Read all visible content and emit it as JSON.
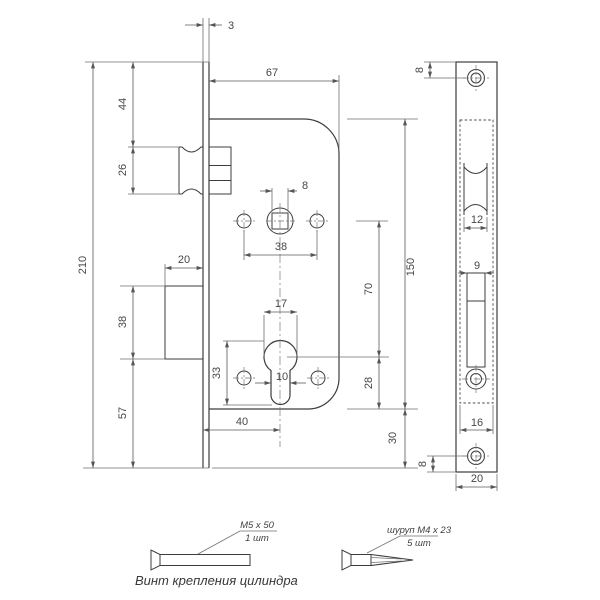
{
  "left_view": {
    "dims": {
      "faceplate_thickness": "3",
      "body_width": "67",
      "top_to_latch": "44",
      "latch_height": "26",
      "total_height": "210",
      "deadbolt_depth": "20",
      "deadbolt_height": "38",
      "bottom_margin": "57",
      "spindle_square": "8",
      "handle_screw_spacing": "38",
      "body_height": "150",
      "spindle_to_cylinder": "70",
      "cylinder_to_bottom": "28",
      "body_to_plate_bottom": "30",
      "cylinder_width": "17",
      "cylinder_height": "33",
      "cylinder_slot_width": "10",
      "backset": "40"
    }
  },
  "right_view": {
    "dims": {
      "top_screw_offset": "8",
      "latch_width": "12",
      "deadbolt_slot_width": "9",
      "body_width": "16",
      "bottom_screw_offset": "8",
      "plate_width": "20"
    }
  },
  "hardware": {
    "cylinder_screw": {
      "spec": "M5 x 50",
      "qty": "1 шт"
    },
    "wood_screw": {
      "spec": "шуруп M4 x 23",
      "qty": "5 шт"
    },
    "caption": "Винт крепления цилиндра"
  }
}
